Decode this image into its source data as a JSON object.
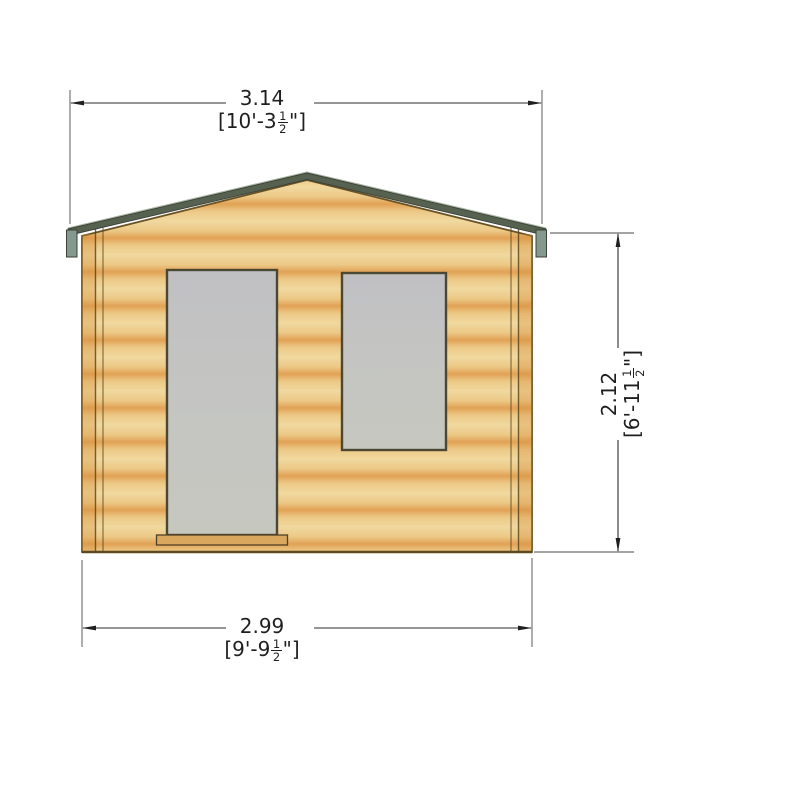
{
  "drawing": {
    "type": "front-elevation-technical-drawing",
    "subject": "log-cabin-with-door-and-window"
  },
  "dimensions": {
    "overall_width": {
      "metric": "3.14",
      "imperial_prefix": "[10'-3",
      "fraction_numerator": "1",
      "fraction_denominator": "2",
      "imperial_suffix": "\"]"
    },
    "base_width": {
      "metric": "2.99",
      "imperial_prefix": "[9'-9",
      "fraction_numerator": "1",
      "fraction_denominator": "2",
      "imperial_suffix": "\"]"
    },
    "wall_height": {
      "metric": "2.12",
      "imperial_prefix": "[6'-11",
      "fraction_numerator": "1",
      "fraction_denominator": "2",
      "imperial_suffix": "\"]"
    }
  },
  "colors": {
    "wood_light": "#f0d89f",
    "wood_mid": "#ecc987",
    "wood_dark": "#e1a255",
    "facade_outline": "#6a5426",
    "fascia": "#57614f",
    "fascia_highlight": "#a9b4a4",
    "end_cap": "#84988e",
    "glass": "#c4c5c2",
    "frame": "#4c4733",
    "sill": "#d9a75e",
    "dimension_line": "#2e2e2e",
    "background": "#ffffff"
  }
}
